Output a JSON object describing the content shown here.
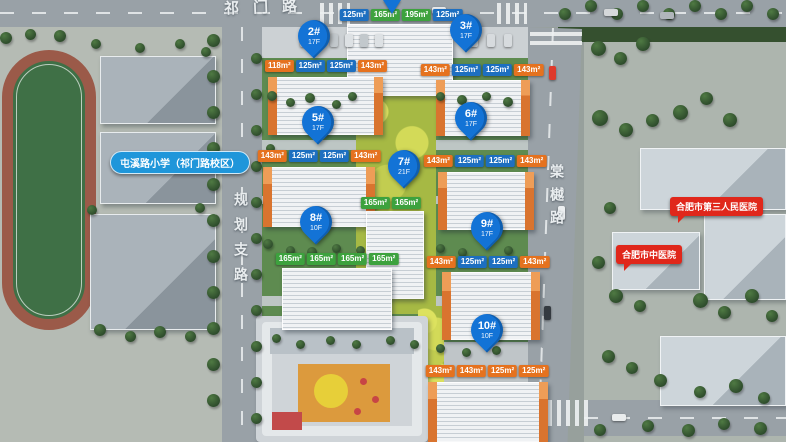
{
  "roads": {
    "top": {
      "label": "祁门路"
    },
    "left": {
      "label": "规划支路"
    },
    "right": {
      "label": "棠樾路"
    }
  },
  "pois": {
    "school": {
      "label": "屯溪路小学（祁门路校区）"
    },
    "hospital_third_peoples": {
      "label": "合肥市第三人民医院"
    },
    "hospital_tcm": {
      "label": "合肥市中医院"
    }
  },
  "colors": {
    "pin_blue": "#1373d6",
    "tag_blue": "#1d6fc0",
    "tag_orange": "#e5721f",
    "tag_green": "#3da23e",
    "bubble_red": "#e0271b",
    "pill_blue": "#1f96da"
  },
  "buildings": [
    {
      "id": "1#",
      "floors": "",
      "pin": null,
      "tail": {
        "x": 392,
        "y": 0
      },
      "tags": {
        "x": 401,
        "y": 9,
        "items": [
          {
            "label": "125m²",
            "color": "blue"
          },
          {
            "label": "165m²",
            "color": "green"
          },
          {
            "label": "195m²",
            "color": "green"
          },
          {
            "label": "125m²",
            "color": "blue"
          }
        ]
      }
    },
    {
      "id": "2#",
      "floors": "17F",
      "pin": {
        "x": 314,
        "y": 20
      },
      "tags": {
        "x": 326,
        "y": 60,
        "items": [
          {
            "label": "118m²",
            "color": "orange"
          },
          {
            "label": "125m²",
            "color": "blue"
          },
          {
            "label": "125m²",
            "color": "blue"
          },
          {
            "label": "143m²",
            "color": "orange"
          }
        ]
      }
    },
    {
      "id": "3#",
      "floors": "17F",
      "pin": {
        "x": 466,
        "y": 14
      },
      "tags": {
        "x": 482,
        "y": 64,
        "items": [
          {
            "label": "143m²",
            "color": "orange"
          },
          {
            "label": "125m²",
            "color": "blue"
          },
          {
            "label": "125m²",
            "color": "blue"
          },
          {
            "label": "143m²",
            "color": "orange"
          }
        ]
      }
    },
    {
      "id": "5#",
      "floors": "17F",
      "pin": {
        "x": 318,
        "y": 106
      },
      "tags": {
        "x": 319,
        "y": 150,
        "items": [
          {
            "label": "143m²",
            "color": "orange"
          },
          {
            "label": "125m²",
            "color": "blue"
          },
          {
            "label": "125m²",
            "color": "blue"
          },
          {
            "label": "143m²",
            "color": "orange"
          }
        ]
      }
    },
    {
      "id": "6#",
      "floors": "17F",
      "pin": {
        "x": 471,
        "y": 102
      },
      "tags": {
        "x": 485,
        "y": 155,
        "items": [
          {
            "label": "143m²",
            "color": "orange"
          },
          {
            "label": "125m²",
            "color": "blue"
          },
          {
            "label": "125m²",
            "color": "blue"
          },
          {
            "label": "143m²",
            "color": "orange"
          }
        ]
      }
    },
    {
      "id": "7#",
      "floors": "21F",
      "pin": {
        "x": 404,
        "y": 150
      },
      "tags": {
        "x": 391,
        "y": 197,
        "items": [
          {
            "label": "165m²",
            "color": "green"
          },
          {
            "label": "165m²",
            "color": "green"
          }
        ]
      }
    },
    {
      "id": "8#",
      "floors": "10F",
      "pin": {
        "x": 316,
        "y": 206
      },
      "tags": {
        "x": 337,
        "y": 253,
        "items": [
          {
            "label": "165m²",
            "color": "green"
          },
          {
            "label": "165m²",
            "color": "green"
          },
          {
            "label": "165m²",
            "color": "green"
          },
          {
            "label": "165m²",
            "color": "green"
          }
        ]
      }
    },
    {
      "id": "9#",
      "floors": "17F",
      "pin": {
        "x": 487,
        "y": 212
      },
      "tags": {
        "x": 488,
        "y": 256,
        "items": [
          {
            "label": "143m²",
            "color": "orange"
          },
          {
            "label": "125m²",
            "color": "blue"
          },
          {
            "label": "125m²",
            "color": "blue"
          },
          {
            "label": "143m²",
            "color": "orange"
          }
        ]
      }
    },
    {
      "id": "10#",
      "floors": "10F",
      "pin": {
        "x": 487,
        "y": 314
      },
      "tags": {
        "x": 487,
        "y": 365,
        "items": [
          {
            "label": "143m²",
            "color": "orange"
          },
          {
            "label": "143m²",
            "color": "orange"
          },
          {
            "label": "125m²",
            "color": "orange"
          },
          {
            "label": "125m²",
            "color": "orange"
          }
        ]
      }
    }
  ]
}
